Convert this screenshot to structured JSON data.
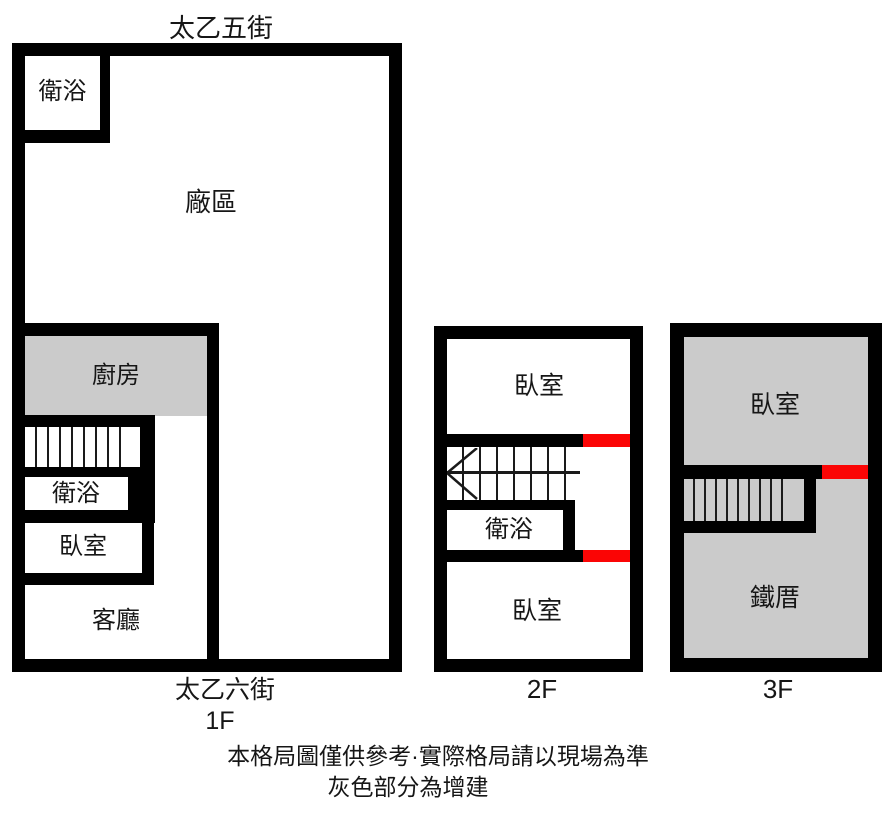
{
  "colors": {
    "wall": "#000000",
    "addition_gray": "#cbcbcb",
    "door_red": "#fb0505"
  },
  "floor1": {
    "street_top": "太乙五街",
    "street_bottom": "太乙六街",
    "label": "1F",
    "rooms": {
      "bathroom_top": "衛浴",
      "factory": "廠區",
      "kitchen": "廚房",
      "bathroom": "衛浴",
      "bedroom": "臥室",
      "living_room": "客廳"
    }
  },
  "floor2": {
    "label": "2F",
    "rooms": {
      "bedroom_top": "臥室",
      "bathroom": "衛浴",
      "bedroom_bottom": "臥室"
    }
  },
  "floor3": {
    "label": "3F",
    "rooms": {
      "bedroom": "臥室",
      "iron_house": "鐵厝"
    }
  },
  "footer": {
    "line1": "本格局圖僅供參考·實際格局請以現場為準",
    "line2": "灰色部分為增建"
  }
}
